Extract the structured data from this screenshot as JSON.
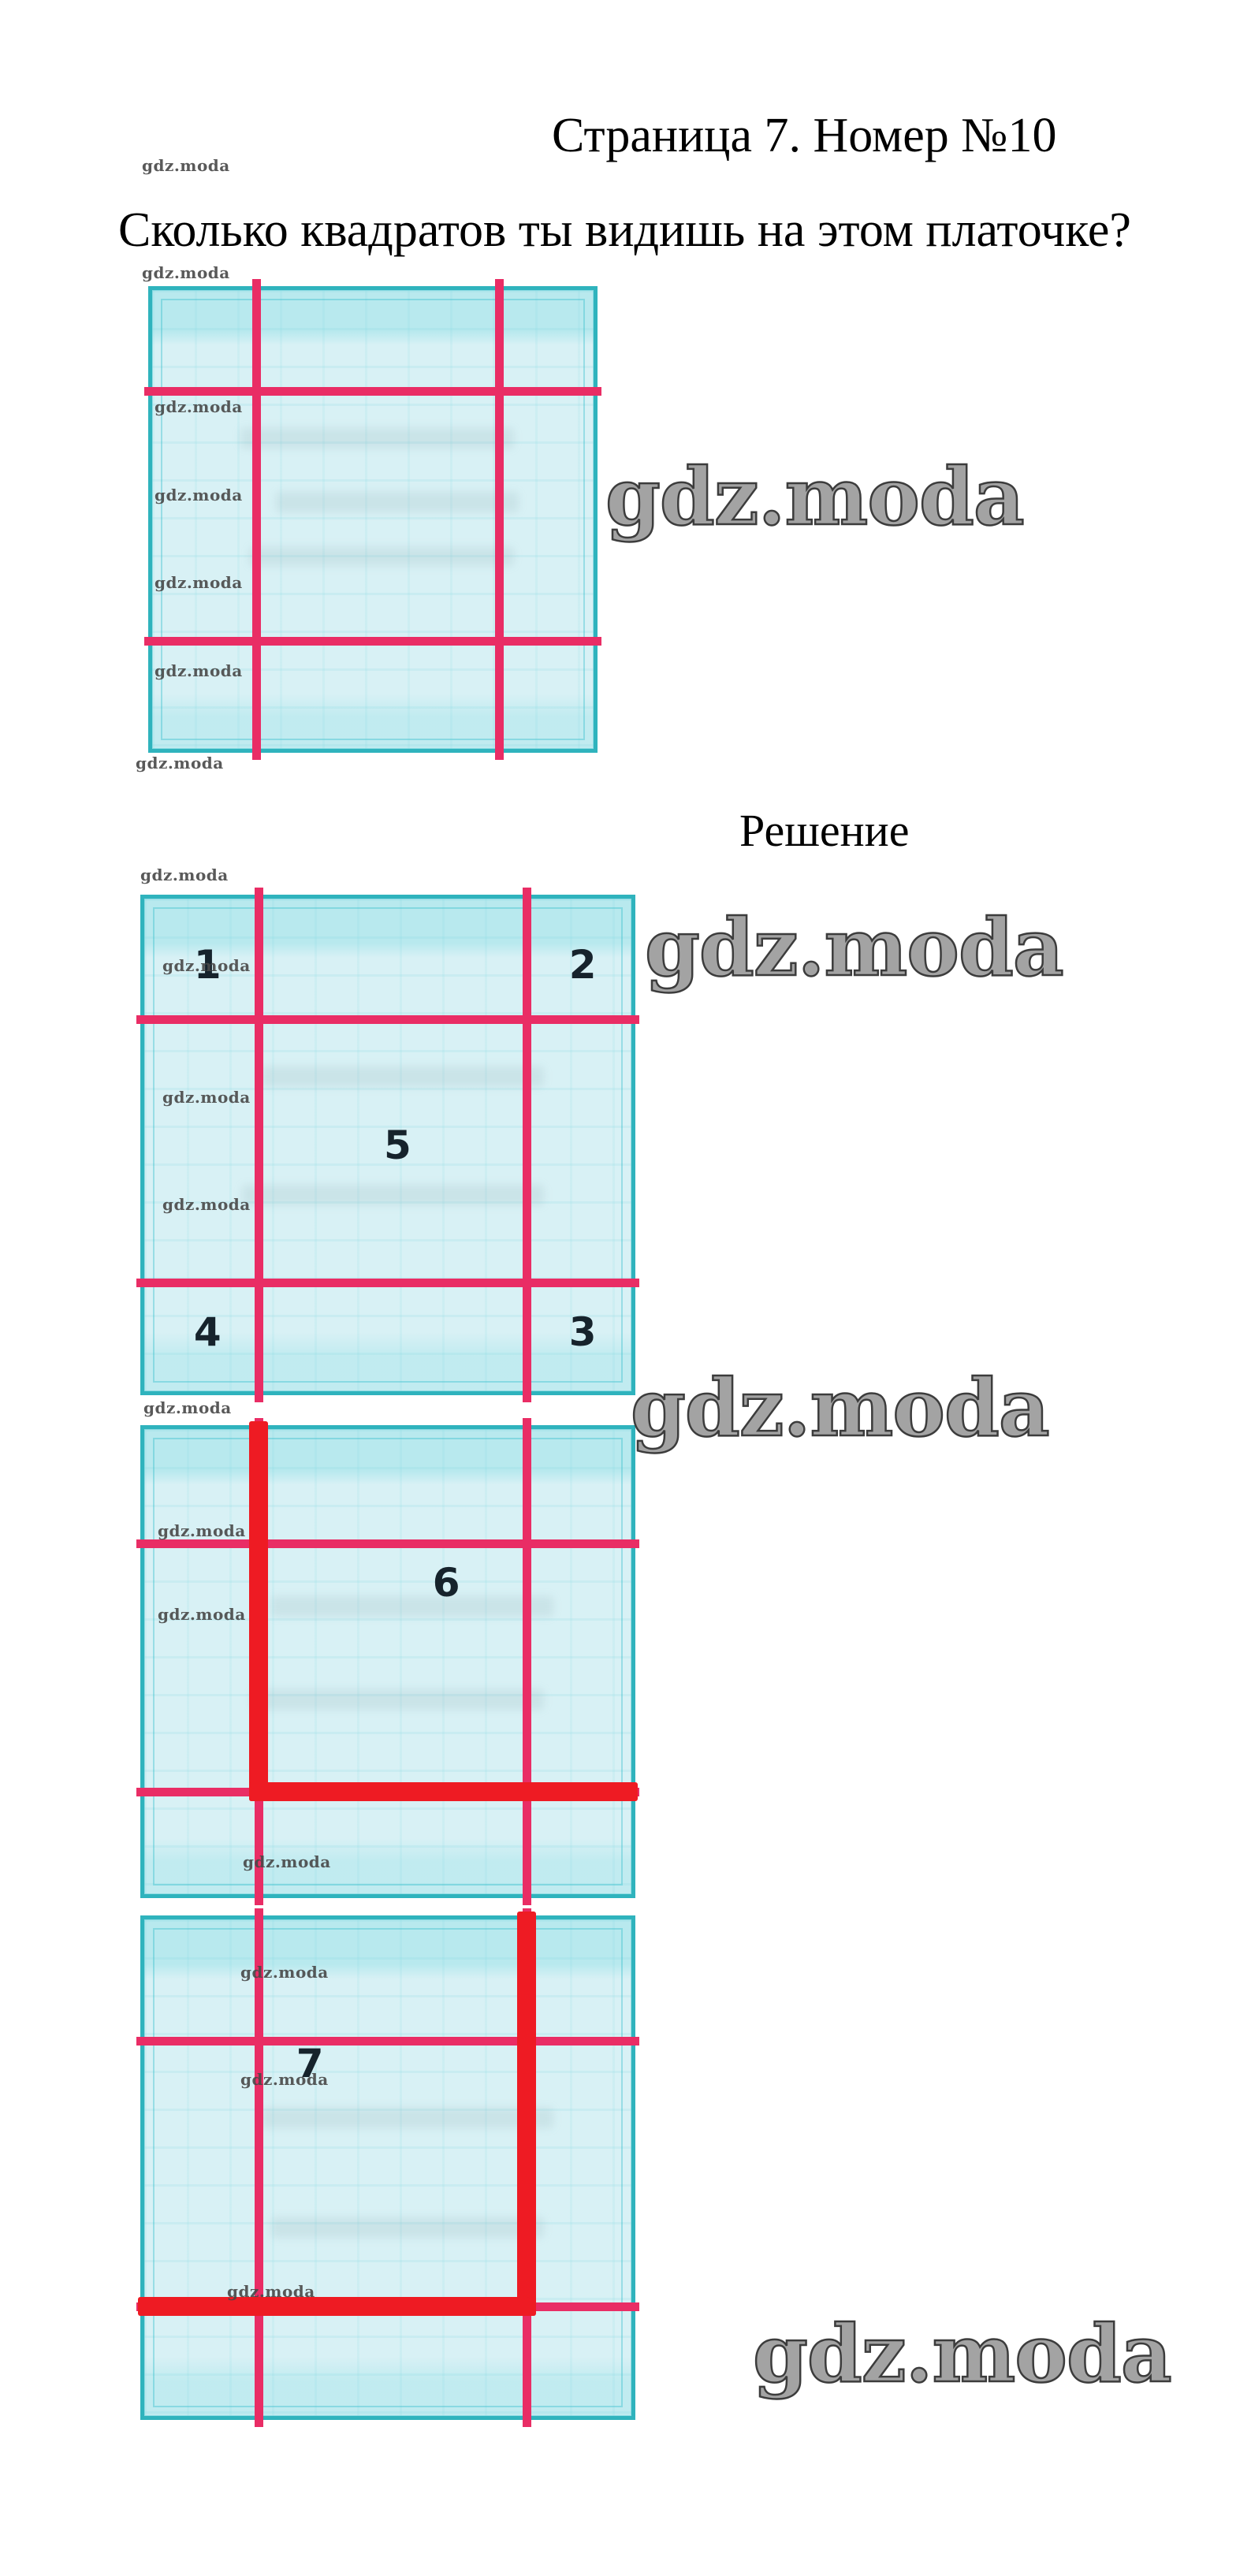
{
  "page": {
    "title": "Страница 7. Номер №10",
    "question": "Сколько квадратов ты видишь на этом платочке?",
    "solution_heading": "Решение"
  },
  "watermark": {
    "text": "gdz.moda"
  },
  "figure": {
    "squares": [
      {
        "name": "problem-handkerchief",
        "labels": []
      },
      {
        "name": "solution-corner-and-center-squares",
        "labels": [
          "1",
          "2",
          "5",
          "4",
          "3"
        ]
      },
      {
        "name": "solution-square-six",
        "labels": [
          "6"
        ]
      },
      {
        "name": "solution-square-seven",
        "labels": [
          "7"
        ]
      }
    ]
  },
  "colors": {
    "cloth_fill": "#d8f1f5",
    "cloth_border": "#2fb3bd",
    "grid_pink": "#e92d65",
    "highlight_red": "#ee1b23",
    "digit": "#16232c",
    "watermark_small": "#484848",
    "watermark_large": "#a3a3a3"
  }
}
